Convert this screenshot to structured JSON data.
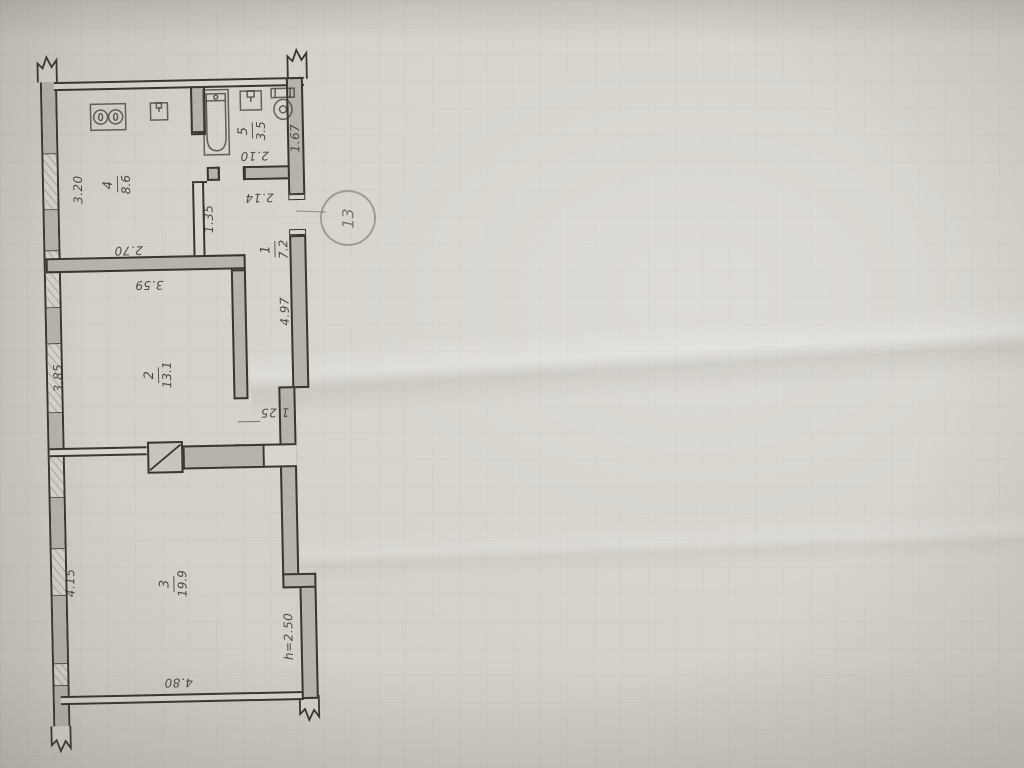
{
  "plan": {
    "stamp": "13",
    "height_note": "h=2.50",
    "rooms": [
      {
        "id": "room-1",
        "number": "1",
        "area": "7.2",
        "dims": [
          "4.97",
          "1.25",
          "2.14",
          "1.35"
        ]
      },
      {
        "id": "room-2",
        "number": "2",
        "area": "13.1",
        "dims": [
          "3.59",
          "3.85"
        ]
      },
      {
        "id": "room-3",
        "number": "3",
        "area": "19.9",
        "dims": [
          "4.15",
          "4.80"
        ]
      },
      {
        "id": "room-4",
        "number": "4",
        "area": "8.6",
        "dims": [
          "3.20",
          "2.70"
        ]
      },
      {
        "id": "room-5",
        "number": "5",
        "area": "3.5",
        "dims": [
          "2.10",
          "1.67"
        ]
      }
    ],
    "fixtures": {
      "kitchen": [
        "stove-icon",
        "sink-icon"
      ],
      "bathroom": [
        "bathtub-icon",
        "washbasin-icon",
        "toilet-icon"
      ],
      "shaft": "vent-shaft-icon"
    },
    "colors": {
      "paper": "#d3d0c9",
      "ink": "#39362f",
      "wall_fill": "#b7b3aa",
      "pencil": "#55524c"
    }
  }
}
